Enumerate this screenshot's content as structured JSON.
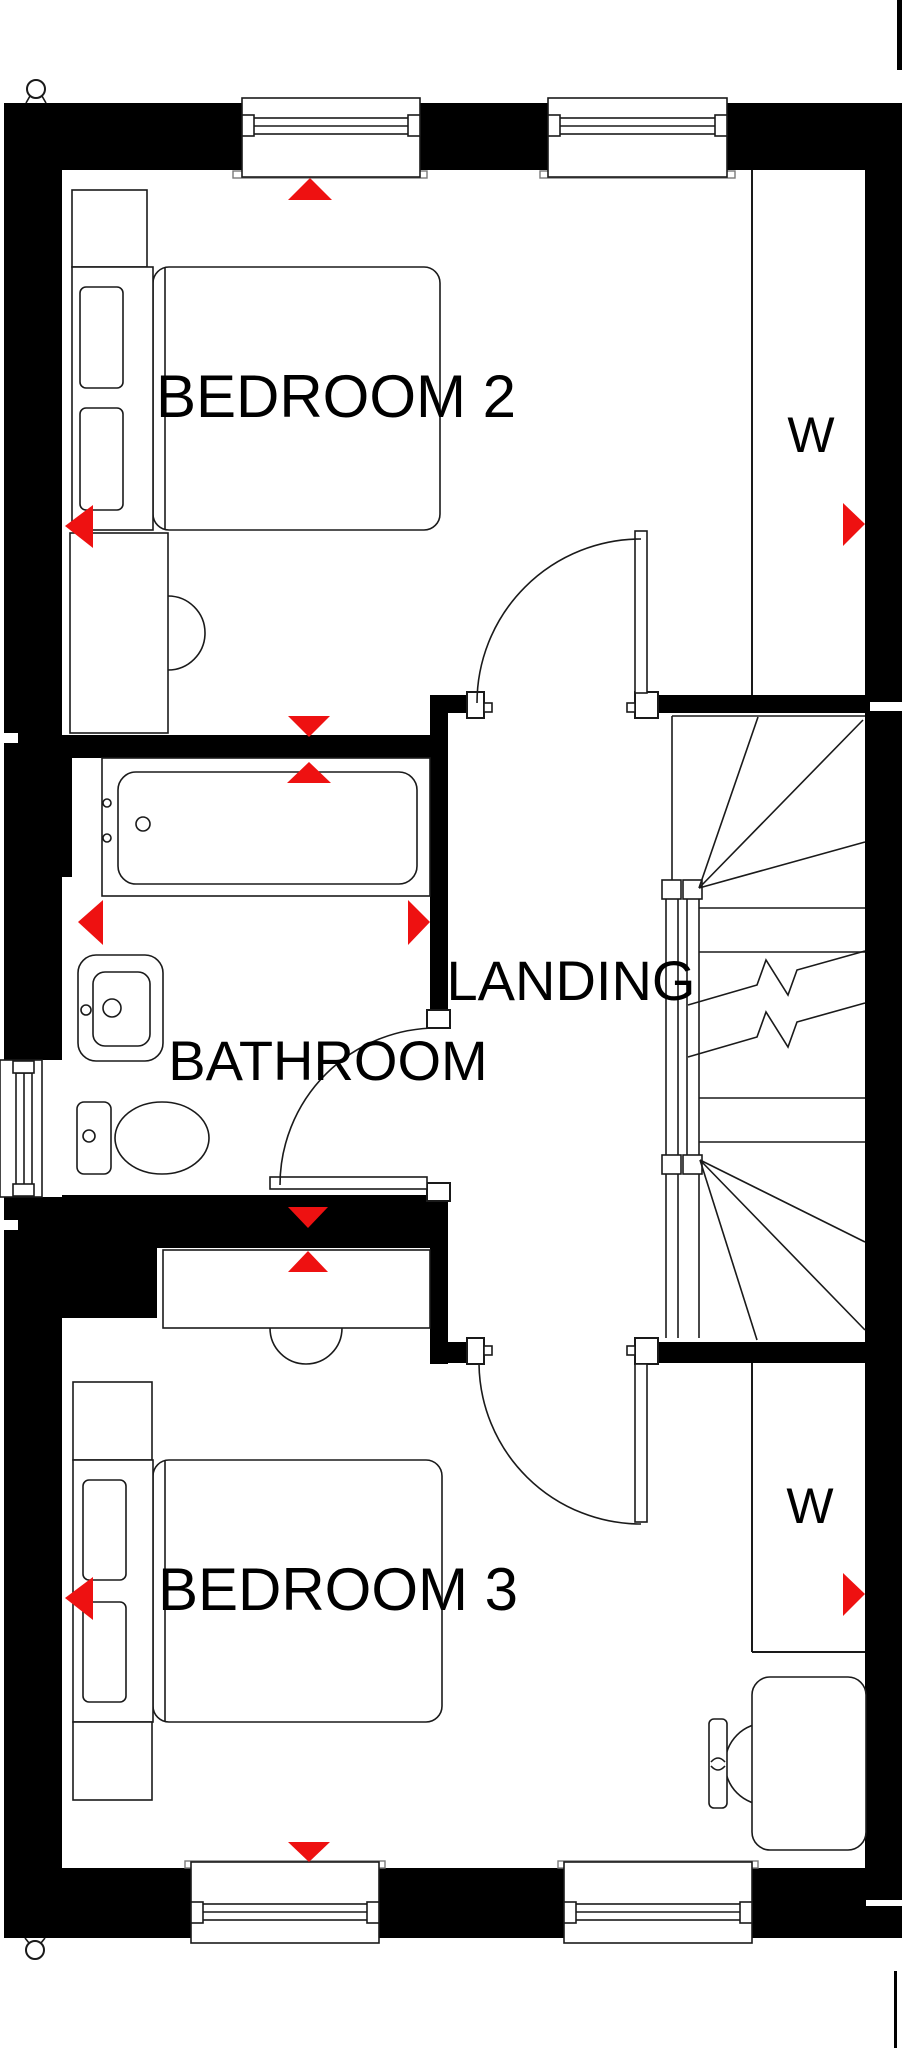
{
  "floorplan": {
    "labels": {
      "bedroom2": "BEDROOM 2",
      "bathroom": "BATHROOM",
      "landing": "LANDING",
      "bedroom3": "BEDROOM 3",
      "wardrobe_top": "W",
      "wardrobe_bottom": "W"
    },
    "colors": {
      "wall": "#000000",
      "bg": "#ffffff",
      "line": "#1a1a1a",
      "marker": "#ee1111"
    }
  }
}
